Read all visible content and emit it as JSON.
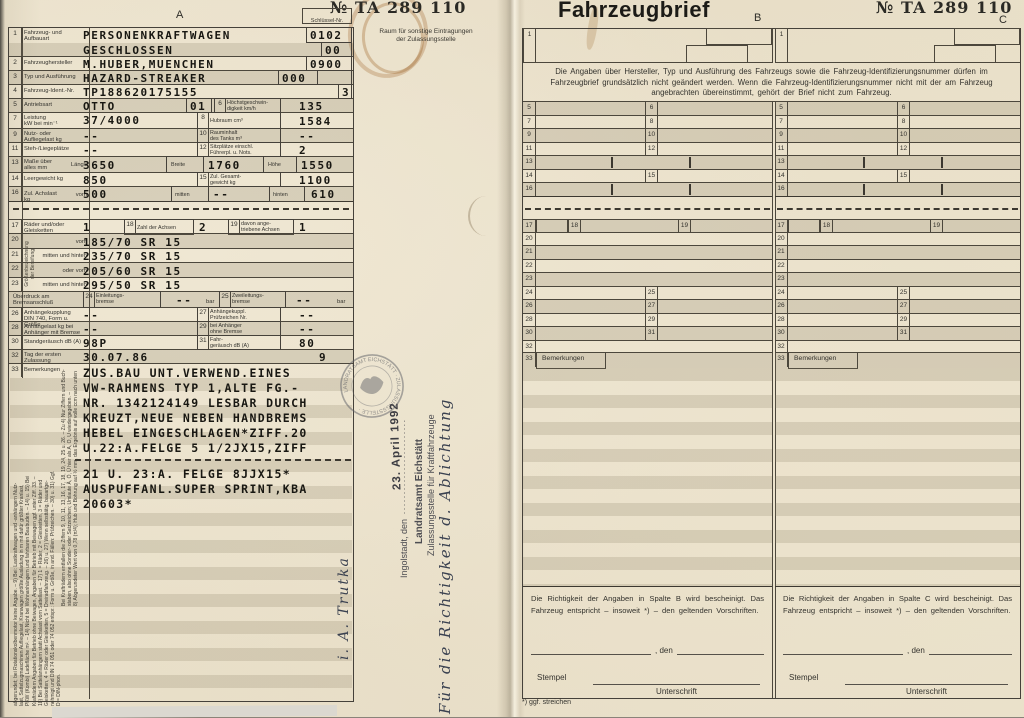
{
  "page": {
    "serial": "№ TA 289 110",
    "title": "Fahrzeugbrief",
    "col_a": "A",
    "col_b": "B",
    "col_c": "C",
    "schluessel_label": "Schlüssel-Nr.",
    "raum_note": "Raum für sonstige Eintragungen\nder Zulassungsstelle"
  },
  "L": {
    "n1": "1",
    "l1": "Fahrzeug- und\nAufbauart",
    "v1a": "PERSONENKRAFTWAGEN",
    "c1a": "0102",
    "v1b": "GESCHLOSSEN",
    "c1b": "00",
    "n2": "2",
    "l2": "Fahrzeughersteller",
    "v2": "M.HUBER,MUENCHEN",
    "c2": "0900",
    "n3": "3",
    "l3": "Typ und Ausführung",
    "v3": "HAZARD-STREAKER",
    "c3": "000",
    "n4": "4",
    "l4": "Fahrzeug-Ident.-Nr.",
    "v4": "TP188620175155",
    "c4": "3",
    "n5": "5",
    "l5": "Antriebsart",
    "v5": "OTTO",
    "b5": "01",
    "n6": "6",
    "l6": "Höchstgeschwin-\ndigkeit km/h",
    "v6": "135",
    "n7": "7",
    "l7": "Leistung\nkW bei min⁻¹",
    "v7": "37/4000",
    "n8": "8",
    "l8": "Hubraum cm³",
    "v8": "1584",
    "n9": "9",
    "l9": "Nutz- oder\nAufliegelast kg",
    "v9": "--",
    "n10": "10",
    "l10": "Rauminhalt\ndes Tanks m³",
    "v10": "--",
    "n11": "11",
    "l11": "Steh-/Liegeplätze",
    "v11": "--",
    "n12": "12",
    "l12": "Sitzplätze einschl.\nFührerpl. u. Nots.",
    "v12": "2",
    "n13": "13",
    "l13": "Maße über\nalles mm",
    "s13a": "Länge",
    "v13a": "3650",
    "s13b": "Breite",
    "v13b": "1760",
    "s13c": "Höhe",
    "v13c": "1550",
    "n14": "14",
    "l14": "Leergewicht kg",
    "v14": "850",
    "n15": "15",
    "l15": "Zul. Gesamt-\ngewicht kg",
    "v15": "1100",
    "n16": "16",
    "l16": "Zul. Achslast kg",
    "s16a": "vorn",
    "v16a": "500",
    "s16b": "mitten",
    "v16b": "--",
    "s16c": "hinten",
    "v16c": "610",
    "n17": "17",
    "l17": "Räder und/oder\nGleisketten",
    "v17": "1",
    "n18": "18",
    "l18": "Zahl der Achsen",
    "v18": "2",
    "n19": "19",
    "l19": "davon ange-\ntriebene Achsen",
    "v19": "1",
    "tire_side": "Größenbezeichnung\nder Bereifung",
    "n20": "20",
    "s20": "vorn",
    "v20": "185/70 SR 15",
    "n21": "21",
    "s21": "mitten und hinten",
    "v21": "235/70 SR 15",
    "n22": "22",
    "s22": "oder vorn",
    "v22": "205/60 SR 15",
    "n23": "23",
    "s23": "mitten und hinten",
    "v23": "295/50 SR 15",
    "l24h": "Überdruck am\nBremsanschluß",
    "n24": "24",
    "l24": "Einleitungs-\nbremse",
    "v24": "--",
    "u24": "bar",
    "n25": "25",
    "l25": "Zweileitungs-\nbremse",
    "v25": "--",
    "u25": "bar",
    "n26": "26",
    "l26": "Anhängekupplung\nDIN 740, Form u. Größe",
    "v26": "--",
    "n27": "27",
    "l27": "Anhängekuppl.\nPrüfzeichen Nr.",
    "v27": "--",
    "n28": "28",
    "l28": "Anhängelast kg bei\nAnhänger mit Bremse",
    "v28": "--",
    "n29": "29",
    "l29": "bei Anhänger\nohne Bremse",
    "v29": "--",
    "n30": "30",
    "l30": "Standgeräusch  dB (A)",
    "v30": "98P",
    "n31": "31",
    "l31": "Fahr-\ngeräusch   dB (A)",
    "v31": "80",
    "n32": "32",
    "l32": "Tag der ersten\nZulassung",
    "v32": "30.07.86",
    "v32b": "9",
    "n33": "33",
    "l33": "Bemerkungen",
    "bem1": "ZUS.BAU UNT.VERWEND.EINES\nVW-RAHMENS TYP 1,ALTE FG.-\nNR. 1342124149 LESBAR DURCH\nKREUZT,NEUE NEBEN HANDBREMS\nHEBEL EINGESCHLAGEN*ZIFF.20\nU.22:A.FELGE 5 1/2JX15,ZIFF",
    "bem2": "21 U. 23:A. FELGE  8JJX15*\nAUSPUFFANL.SUPER SPRINT,KBA\n20603*",
    "fineA": "abgerundet; bei Rotationskolbenmotor keine Angabe. – 9) Bei: Lastkraftwagen und -anhängern Nutz-\nlast, Sattelzugmaschinen Aufliegelast, Kranwagen größte Ausladung in m mit dafür größter Kranlast,\nPKW (Kombi) Ladefläche m². – 14) Nicht bei Wohnanhängern und fahrbaren Baubuden. – 14) u. 15) Bei\nKrafträdern Angaben für Betrieb ohne Beiwagen, Angaben für Betrieb mit Beiwagen ggf. unter Ziff. 33. –\n18) Bei Sattelanhängern statt Achslast vorn Sattellast. – 17) 1 = Räder, 2 = Gleisketten, 3 = Räder und\nGleisketten, 4 = Räder oder Gleisketten, 5 = Dreiradfahrzeug. – 26) u. 27) Wenn selbsttätig, bauartge-\nnehmigt und DIN 74 051 oder 74 052 entspr.: Form u. Größe, in and. Fällen: Prüfzeichen. – 30) u. 31) Ggf.\nD = DIN-phon.",
    "fineB": "Bei Krafträdern entfallen die Ziffern 9, 10, 11, 13, 16, 17, 18, 19, 24, 25 u. 26. – Zu 4) Nur Ziffern und Buch-\nstaben, also ohne Sonder- oder Satzzeichen; Umlaute Ä, Ö, Ü hier als A, O, U wiedergegeben. –\n8) Abgerundeter Wert von 0,78 (π/4); Hub und Bohrung auf ½ mm, das Ergebnis auf volle ccm nach unten"
  },
  "M": {
    "stamp_city": "Ingolstadt, den",
    "stamp_dots": "························",
    "stamp_date": "23. April 1992",
    "stamp_office": "Landratsamt Eichstätt",
    "stamp_dept": "Zulassungsstelle für Kraftfahrzeuge",
    "handwriting": "Für die Richtigkeit d. Ablichtung",
    "signature": "i. A. Trutka",
    "round_stamp": "LANDRATSAMT EICHSTÄTT · ZULASSUNGSSTELLE ·"
  },
  "R": {
    "n1": "1",
    "n5": "5",
    "n6": "6",
    "n7": "7",
    "n8": "8",
    "n9": "9",
    "n10": "10",
    "n11": "11",
    "n12": "12",
    "n13": "13",
    "n14": "14",
    "n15": "15",
    "n16": "16",
    "n17": "17",
    "n18": "18",
    "n19": "19",
    "n20": "20",
    "n21": "21",
    "n22": "22",
    "n23": "23",
    "n24": "24",
    "n25": "25",
    "n26": "26",
    "n27": "27",
    "n28": "28",
    "n29": "29",
    "n30": "30",
    "n31": "31",
    "n32": "32",
    "n33": "33",
    "notice": "Die Angaben über Hersteller, Typ und Ausführung des Fahrzeugs sowie die Fahrzeug-Identifizierungsnummer dürfen im Fahrzeugbrief grundsätzlich nicht geändert werden. Wenn die Fahrzeug-Identifizierungsnummer nicht mit der am Fahrzeug angebrachten übereinstimmt, gehört der Brief nicht zum Fahrzeug.",
    "bem_label": "Bemerkungen",
    "cert_b": "Die Richtigkeit der Angaben in Spalte B wird bescheinigt. Das Fahrzeug entspricht – insoweit *) – den geltenden Vorschriften.",
    "cert_c": "Die Richtigkeit der Angaben in Spalte C wird bescheinigt. Das Fahrzeug entspricht – insoweit *) – den geltenden Vorschriften.",
    "den": ", den",
    "stempel": "Stempel",
    "unterschrift": "Unterschrift",
    "foot": "*) ggf. streichen"
  },
  "colors": {
    "paper": "#eae1cb",
    "stripe": "rgba(126,115,88,0.20)",
    "line": "#4c473c",
    "ink": "#181712",
    "stamp_ink": "#4d4d52",
    "hand_ink": "#3a4150"
  }
}
